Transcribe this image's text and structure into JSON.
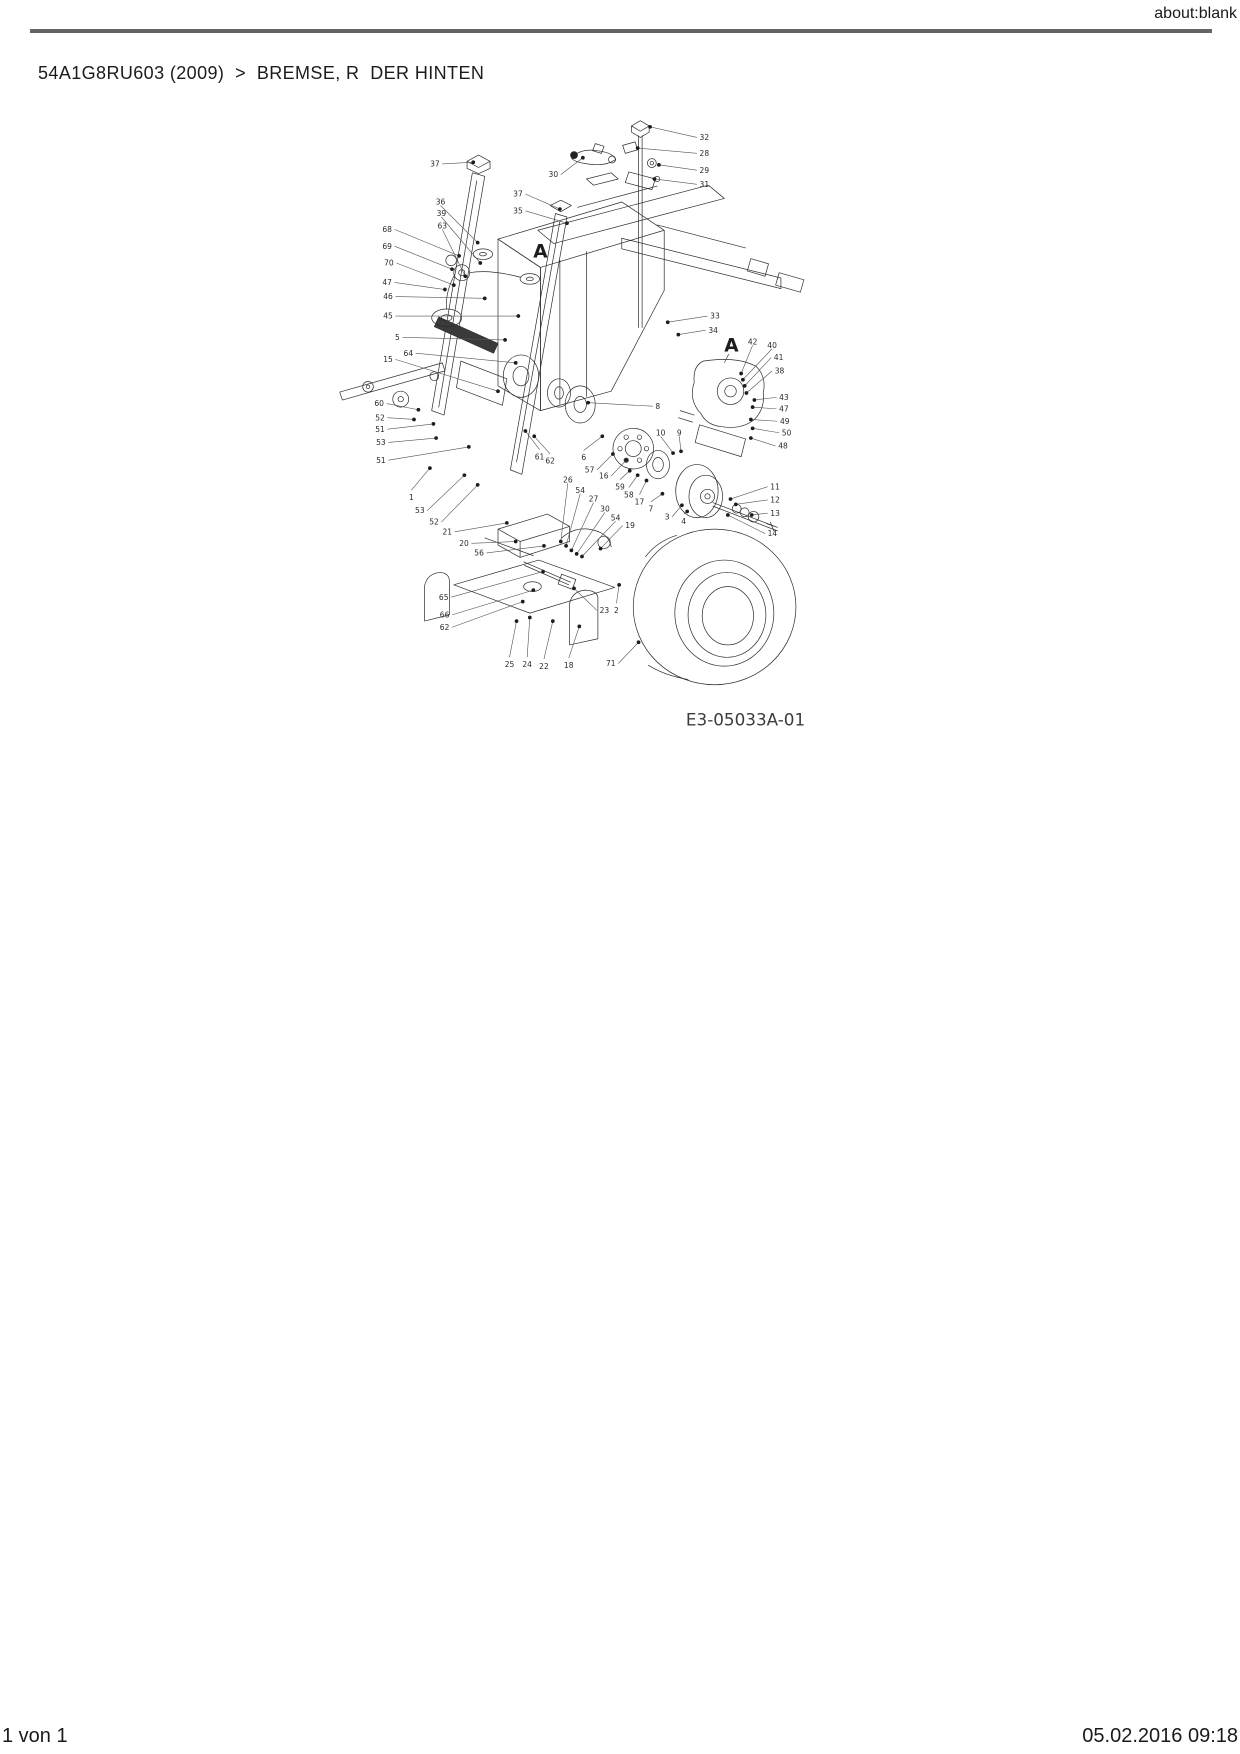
{
  "page": {
    "header_right": "about:blank",
    "title": "54A1G8RU603 (2009)  >  BREMSE, R  DER HINTEN",
    "footer_left": "1 von 1",
    "footer_right": "05.02.2016 09:18"
  },
  "diagram": {
    "code": "E3-05033A-01",
    "markers": [
      {
        "t": "A",
        "x": 568,
        "y": 272
      },
      {
        "t": "A",
        "x": 784,
        "y": 378,
        "tx": 776,
        "ty": 398
      }
    ],
    "labels": [
      {
        "t": "37",
        "x": 454,
        "y": 173,
        "tx": 492,
        "ty": 171
      },
      {
        "t": "36",
        "x": 455,
        "y": 216,
        "tx": 497,
        "ty": 262
      },
      {
        "t": "39",
        "x": 456,
        "y": 229,
        "tx": 500,
        "ty": 285
      },
      {
        "t": "63",
        "x": 457,
        "y": 243,
        "tx": 483,
        "ty": 300
      },
      {
        "t": "68",
        "x": 400,
        "y": 247,
        "tx": 476,
        "ty": 277
      },
      {
        "t": "69",
        "x": 400,
        "y": 266,
        "tx": 468,
        "ty": 292
      },
      {
        "t": "70",
        "x": 402,
        "y": 285,
        "tx": 470,
        "ty": 310
      },
      {
        "t": "47",
        "x": 400,
        "y": 307,
        "tx": 460,
        "ty": 315
      },
      {
        "t": "46",
        "x": 401,
        "y": 323,
        "tx": 505,
        "ty": 325
      },
      {
        "t": "45",
        "x": 401,
        "y": 345,
        "tx": 543,
        "ty": 345
      },
      {
        "t": "5",
        "x": 409,
        "y": 369,
        "tx": 528,
        "ty": 372
      },
      {
        "t": "64",
        "x": 424,
        "y": 387,
        "tx": 540,
        "ty": 398
      },
      {
        "t": "15",
        "x": 401,
        "y": 394,
        "tx": 520,
        "ty": 430
      },
      {
        "t": "60",
        "x": 391,
        "y": 444,
        "tx": 430,
        "ty": 451
      },
      {
        "t": "52",
        "x": 392,
        "y": 460,
        "tx": 425,
        "ty": 462
      },
      {
        "t": "51",
        "x": 392,
        "y": 473,
        "tx": 447,
        "ty": 467
      },
      {
        "t": "53",
        "x": 393,
        "y": 488,
        "tx": 450,
        "ty": 483
      },
      {
        "t": "51",
        "x": 393,
        "y": 508,
        "tx": 487,
        "ty": 493
      },
      {
        "t": "1",
        "x": 422,
        "y": 550,
        "tx": 443,
        "ty": 517
      },
      {
        "t": "53",
        "x": 437,
        "y": 565,
        "tx": 482,
        "ty": 525
      },
      {
        "t": "52",
        "x": 453,
        "y": 578,
        "tx": 497,
        "ty": 536
      },
      {
        "t": "21",
        "x": 468,
        "y": 589,
        "tx": 530,
        "ty": 579
      },
      {
        "t": "20",
        "x": 487,
        "y": 602,
        "tx": 540,
        "ty": 600
      },
      {
        "t": "56",
        "x": 504,
        "y": 613,
        "tx": 572,
        "ty": 605
      },
      {
        "t": "65",
        "x": 464,
        "y": 663,
        "tx": 571,
        "ty": 634
      },
      {
        "t": "66",
        "x": 465,
        "y": 683,
        "tx": 560,
        "ty": 655
      },
      {
        "t": "62",
        "x": 465,
        "y": 697,
        "tx": 548,
        "ty": 668
      },
      {
        "t": "25",
        "x": 533,
        "y": 739,
        "tx": 541,
        "ty": 690
      },
      {
        "t": "24",
        "x": 553,
        "y": 739,
        "tx": 556,
        "ty": 686
      },
      {
        "t": "22",
        "x": 572,
        "y": 741,
        "tx": 582,
        "ty": 690
      },
      {
        "t": "18",
        "x": 600,
        "y": 740,
        "tx": 612,
        "ty": 696
      },
      {
        "t": "23",
        "x": 635,
        "y": 678,
        "tx": 606,
        "ty": 653
      },
      {
        "t": "2",
        "x": 654,
        "y": 678,
        "tx": 657,
        "ty": 649
      },
      {
        "t": "71",
        "x": 653,
        "y": 738,
        "tx": 679,
        "ty": 714
      },
      {
        "t": "30",
        "x": 588,
        "y": 185,
        "tx": 616,
        "ty": 166
      },
      {
        "t": "37",
        "x": 548,
        "y": 207,
        "tx": 590,
        "ty": 224
      },
      {
        "t": "35",
        "x": 548,
        "y": 226,
        "tx": 598,
        "ty": 240
      },
      {
        "t": "32",
        "x": 748,
        "y": 143,
        "tx": 692,
        "ty": 131
      },
      {
        "t": "28",
        "x": 748,
        "y": 161,
        "tx": 678,
        "ty": 155
      },
      {
        "t": "29",
        "x": 748,
        "y": 180,
        "tx": 702,
        "ty": 174
      },
      {
        "t": "31",
        "x": 748,
        "y": 196,
        "tx": 697,
        "ty": 190
      },
      {
        "t": "33",
        "x": 760,
        "y": 345,
        "tx": 712,
        "ty": 352
      },
      {
        "t": "34",
        "x": 758,
        "y": 361,
        "tx": 724,
        "ty": 366
      },
      {
        "t": "8",
        "x": 698,
        "y": 447,
        "tx": 622,
        "ty": 443
      },
      {
        "t": "10",
        "x": 704,
        "y": 477,
        "tx": 718,
        "ty": 500
      },
      {
        "t": "9",
        "x": 725,
        "y": 477,
        "tx": 727,
        "ty": 498
      },
      {
        "t": "6",
        "x": 617,
        "y": 505,
        "tx": 638,
        "ty": 481
      },
      {
        "t": "57",
        "x": 629,
        "y": 519,
        "tx": 650,
        "ty": 501
      },
      {
        "t": "16",
        "x": 645,
        "y": 526,
        "tx": 665,
        "ty": 508
      },
      {
        "t": "59",
        "x": 658,
        "y": 538,
        "tx": 669,
        "ty": 520
      },
      {
        "t": "58",
        "x": 668,
        "y": 547,
        "tx": 678,
        "ty": 525
      },
      {
        "t": "17",
        "x": 680,
        "y": 555,
        "tx": 688,
        "ty": 531
      },
      {
        "t": "7",
        "x": 693,
        "y": 563,
        "tx": 706,
        "ty": 546
      },
      {
        "t": "3",
        "x": 714,
        "y": 572,
        "tx": 728,
        "ty": 559
      },
      {
        "t": "4",
        "x": 730,
        "y": 577,
        "tx": 734,
        "ty": 566
      },
      {
        "t": "61",
        "x": 567,
        "y": 504,
        "tx": 551,
        "ty": 475
      },
      {
        "t": "62",
        "x": 579,
        "y": 509,
        "tx": 561,
        "ty": 481
      },
      {
        "t": "26",
        "x": 599,
        "y": 530,
        "tx": 591,
        "ty": 600
      },
      {
        "t": "54",
        "x": 613,
        "y": 542,
        "tx": 597,
        "ty": 605
      },
      {
        "t": "27",
        "x": 628,
        "y": 552,
        "tx": 603,
        "ty": 610
      },
      {
        "t": "30",
        "x": 641,
        "y": 563,
        "tx": 609,
        "ty": 614
      },
      {
        "t": "54",
        "x": 653,
        "y": 573,
        "tx": 615,
        "ty": 617
      },
      {
        "t": "19",
        "x": 664,
        "y": 582,
        "tx": 636,
        "ty": 608
      },
      {
        "t": "11",
        "x": 828,
        "y": 538,
        "tx": 783,
        "ty": 552
      },
      {
        "t": "12",
        "x": 828,
        "y": 553,
        "tx": 789,
        "ty": 558
      },
      {
        "t": "13",
        "x": 828,
        "y": 568,
        "tx": 807,
        "ty": 570
      },
      {
        "t": "14",
        "x": 825,
        "y": 591,
        "tx": 780,
        "ty": 570
      },
      {
        "t": "42",
        "x": 808,
        "y": 374,
        "tx": 795,
        "ty": 410
      },
      {
        "t": "40",
        "x": 830,
        "y": 378,
        "tx": 797,
        "ty": 417
      },
      {
        "t": "41",
        "x": 832,
        "y": 392,
        "tx": 799,
        "ty": 424
      },
      {
        "t": "38",
        "x": 833,
        "y": 407,
        "tx": 801,
        "ty": 432
      },
      {
        "t": "43",
        "x": 838,
        "y": 437,
        "tx": 810,
        "ty": 440
      },
      {
        "t": "47",
        "x": 838,
        "y": 450,
        "tx": 808,
        "ty": 448
      },
      {
        "t": "49",
        "x": 839,
        "y": 464,
        "tx": 806,
        "ty": 462
      },
      {
        "t": "50",
        "x": 841,
        "y": 477,
        "tx": 808,
        "ty": 472
      },
      {
        "t": "48",
        "x": 837,
        "y": 492,
        "tx": 806,
        "ty": 483
      }
    ]
  }
}
